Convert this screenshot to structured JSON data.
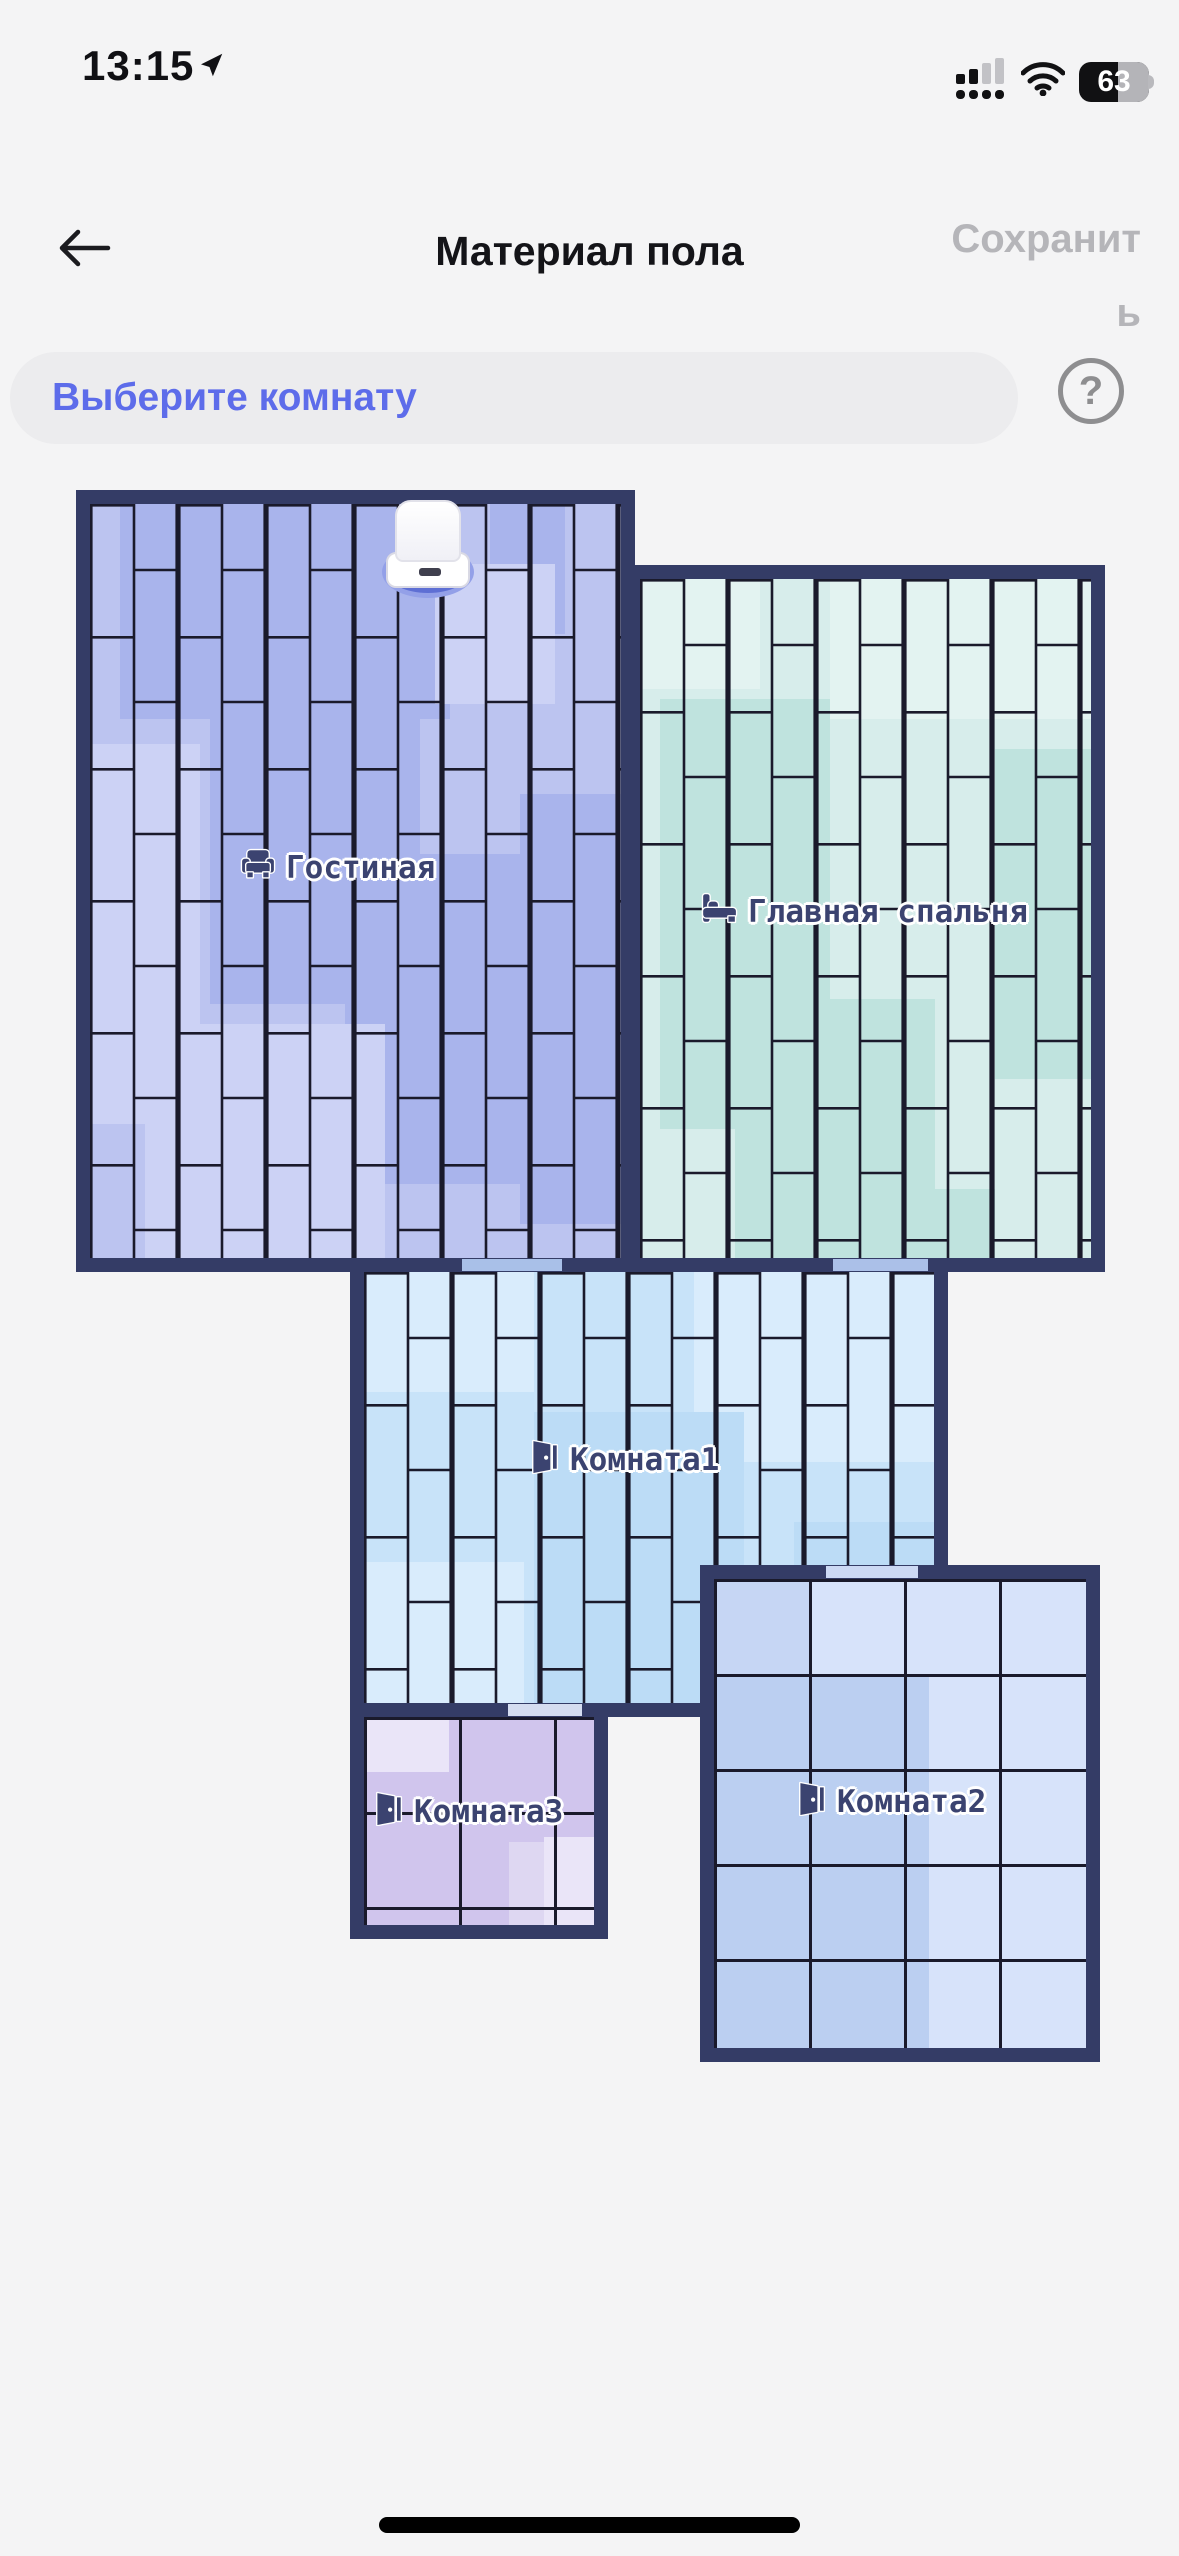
{
  "status_bar": {
    "time": "13:15",
    "battery_percent": "63"
  },
  "header": {
    "title": "Материал пола",
    "save_label": "Сохранить"
  },
  "room_selector": {
    "label": "Выберите комнату",
    "help_glyph": "?"
  },
  "map": {
    "wall_color": "#343c66",
    "grout_color": "#1a1a2b",
    "rooms": [
      {
        "name": "Гостиная",
        "icon": "sofa-icon",
        "tile_pattern": "vertical-brick",
        "base_color": "#bcc4f0"
      },
      {
        "name": "Главная спальня",
        "icon": "bed-icon",
        "tile_pattern": "vertical-brick",
        "base_color": "#d7edeb"
      },
      {
        "name": "Комната1",
        "icon": "door-icon",
        "tile_pattern": "vertical-brick",
        "base_color": "#c8e3f9"
      },
      {
        "name": "Комната3",
        "icon": "door-icon",
        "tile_pattern": "square-grid",
        "base_color": "#ded7f2"
      },
      {
        "name": "Комната2",
        "icon": "door-icon",
        "tile_pattern": "square-grid",
        "base_color": "#c6d6f4"
      }
    ],
    "dock": {
      "name": "Док-станция"
    }
  },
  "colors": {
    "accent_blue": "#5d6cea",
    "background": "#f4f4f5",
    "label_text": "#3b4370",
    "save_gray": "#b5b5b9"
  }
}
